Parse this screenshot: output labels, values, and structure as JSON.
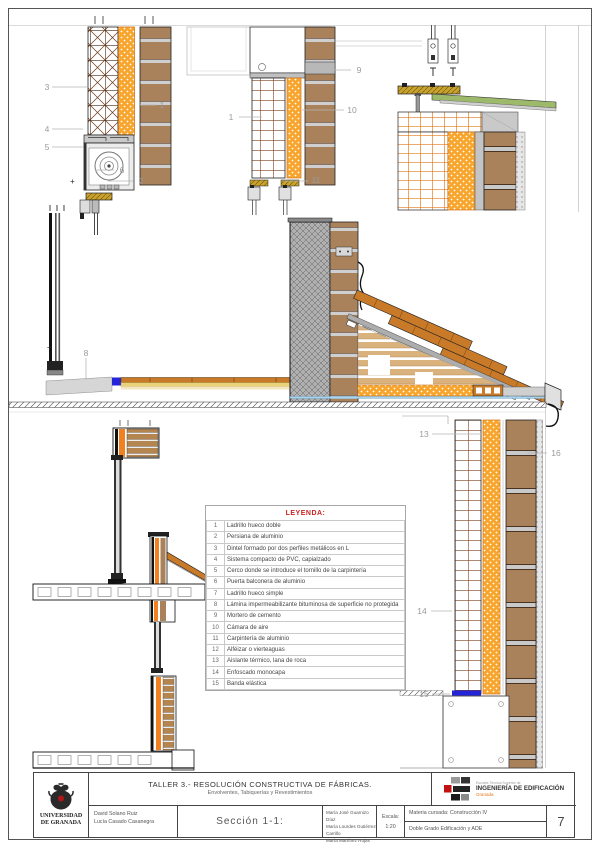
{
  "palette": {
    "brick_facing": "#a9815a",
    "insulation_orange": "#f7a52c",
    "render_gray": "#c4c4c4",
    "flashing_green": "#9db96a",
    "elastic_band_blue": "#2424d8",
    "roof_tile": "#c87a28",
    "hatched_wall_gray": "#b0b0b0",
    "legend_title_red": "#cc2222",
    "callout_gray": "#9a9a9a",
    "logo_red": "#c11111",
    "logo_orange": "#e07818"
  },
  "legend": {
    "title": "LEYENDA:",
    "items": [
      {
        "num": "1",
        "label": "Ladrillo hueco doble"
      },
      {
        "num": "2",
        "label": "Persiana de aluminio"
      },
      {
        "num": "3",
        "label": "Dintel formado por dos perfiles metálicos en L"
      },
      {
        "num": "4",
        "label": "Sistema compacto de PVC, capialzado"
      },
      {
        "num": "5",
        "label": "Cerco donde se introduce el tornillo de la carpintería"
      },
      {
        "num": "6",
        "label": "Puerta balconera de aluminio"
      },
      {
        "num": "7",
        "label": "Ladrillo hueco simple"
      },
      {
        "num": "8",
        "label": "Lámina impermeabilizante bituminosa de superficie no protegida"
      },
      {
        "num": "9",
        "label": "Mortero de cemento"
      },
      {
        "num": "10",
        "label": "Cámara de aire"
      },
      {
        "num": "11",
        "label": "Carpintería de aluminio"
      },
      {
        "num": "12",
        "label": "Alféizar o vierteaguas"
      },
      {
        "num": "13",
        "label": "Aislante térmico, lana de roca"
      },
      {
        "num": "14",
        "label": "Enfoscado monocapa"
      },
      {
        "num": "15",
        "label": "Banda elástica"
      }
    ]
  },
  "callouts": [
    {
      "num": "3",
      "x": 47,
      "y": 87
    },
    {
      "num": "4",
      "x": 47,
      "y": 129
    },
    {
      "num": "5",
      "x": 47,
      "y": 147
    },
    {
      "num": "6",
      "x": 122,
      "y": 170
    },
    {
      "num": "2",
      "x": 141,
      "y": 181
    },
    {
      "num": "1",
      "x": 162,
      "y": 105
    },
    {
      "num": "1",
      "x": 231,
      "y": 117
    },
    {
      "num": "9",
      "x": 359,
      "y": 70
    },
    {
      "num": "10",
      "x": 352,
      "y": 110
    },
    {
      "num": "11",
      "x": 316,
      "y": 180
    },
    {
      "num": "8",
      "x": 86,
      "y": 353
    },
    {
      "num": "13",
      "x": 424,
      "y": 434
    },
    {
      "num": "16",
      "x": 556,
      "y": 453
    },
    {
      "num": "14",
      "x": 422,
      "y": 611
    },
    {
      "num": "15",
      "x": 424,
      "y": 694
    }
  ],
  "title_block": {
    "university_line1": "UNIVERSIDAD",
    "university_line2": "DE GRANADA",
    "project_title": "TALLER 3.- RESOLUCIÓN CONSTRUCTIVA DE FÁBRICAS.",
    "project_subtitle": "Envolventes, Tabiquerías y Revestimientos",
    "school_top": "Escuela Técnica Superior de",
    "school_main": "INGENIERÍA DE EDIFICACIÓN",
    "school_sub": "Granada",
    "authors_left": [
      "David Solano Ruiz",
      "Lucía Casado Casanegra"
    ],
    "section_label": "Sección 1-1:",
    "authors_right": [
      "María José Guarnizo Díaz",
      "María Lourdes Gutiérrez Carrillo",
      "María Martínez Rojas"
    ],
    "scale_label": "Escala:",
    "scale_value": "1:20",
    "course_label": "Materia cursada:",
    "course_value": "Construcción IV",
    "degree": "Doble Grado Edificación y ADE",
    "sheet_number": "7"
  }
}
